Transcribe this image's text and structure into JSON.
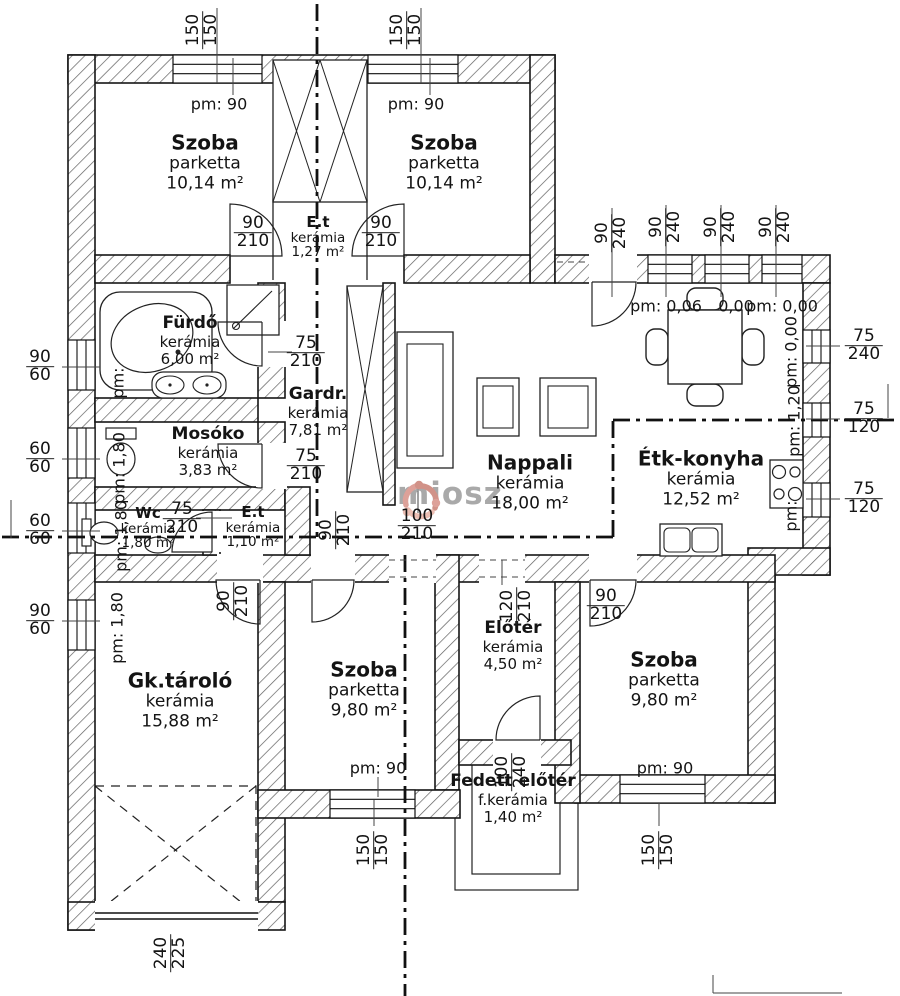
{
  "watermark": {
    "text": "miosz",
    "logo_colors": [
      "#c97f74",
      "#e8b3a6",
      "#d89188"
    ],
    "text_color": "#9b9b9b"
  },
  "rooms": {
    "szoba_tl": {
      "name": "Szoba",
      "floor": "parketta",
      "area": "10,14 m²"
    },
    "szoba_tm": {
      "name": "Szoba",
      "floor": "parketta",
      "area": "10,14 m²"
    },
    "et_top": {
      "name": "E.t",
      "floor": "kerámia",
      "area": "1,27 m²"
    },
    "furdo": {
      "name": "Fürdő",
      "floor": "kerámia",
      "area": "6,00 m²"
    },
    "gardr": {
      "name": "Gardr.",
      "floor": "kerámia",
      "area": "7,81 m²"
    },
    "mosoko": {
      "name": "Mosóko",
      "floor": "kerámia",
      "area": "3,83 m²"
    },
    "wc": {
      "name": "Wc",
      "floor": "kerámia",
      "area": "1,80 m²"
    },
    "et_small": {
      "name": "E.t",
      "floor": "kerámia",
      "area": "1,10 m²"
    },
    "nappali": {
      "name": "Nappali",
      "floor": "kerámia",
      "area": "18,00 m²"
    },
    "etk_konyha": {
      "name": "Étk-konyha",
      "floor": "kerámia",
      "area": "12,52 m²"
    },
    "gk_tarolo": {
      "name": "Gk.tároló",
      "floor": "kerámia",
      "area": "15,88 m²"
    },
    "szoba_bm": {
      "name": "Szoba",
      "floor": "parketta",
      "area": "9,80 m²"
    },
    "eloter": {
      "name": "Előtér",
      "floor": "kerámia",
      "area": "4,50 m²"
    },
    "szoba_br": {
      "name": "Szoba",
      "floor": "parketta",
      "area": "9,80 m²"
    },
    "fedett_eloter": {
      "name": "Fedett előtér",
      "floor": "f.kerámia",
      "area": "1,40 m²"
    }
  },
  "pm_labels": {
    "tl": "pm: 90",
    "tm": "pm: 90",
    "k1": "pm: 0,06",
    "k2": "0,00",
    "k3": "pm: 0,00",
    "kr1": "pm: 0,00",
    "kr2": "pm: 1,20",
    "kr3": "pm:",
    "furdo": "pm:",
    "mosoko": "pm: 1,80",
    "wc": "pm: 1,80",
    "gk": "pm: 1,80",
    "bm": "pm: 90",
    "br": "pm: 90"
  },
  "dims": {
    "tw1": {
      "a": "150",
      "b": "150"
    },
    "tw2": {
      "a": "150",
      "b": "150"
    },
    "trd": {
      "a": "90",
      "b": "240"
    },
    "trw1": {
      "a": "90",
      "b": "240"
    },
    "trw2": {
      "a": "90",
      "b": "240"
    },
    "trw3": {
      "a": "90",
      "b": "240"
    },
    "rw1": {
      "a": "75",
      "b": "240"
    },
    "rw2": {
      "a": "75",
      "b": "120"
    },
    "rw3": {
      "a": "75",
      "b": "120"
    },
    "lw1": {
      "a": "90",
      "b": "60"
    },
    "lw2": {
      "a": "60",
      "b": "60"
    },
    "lw3": {
      "a": "60",
      "b": "60"
    },
    "lw4": {
      "a": "90",
      "b": "60"
    },
    "dtl": {
      "a": "90",
      "b": "210"
    },
    "dtm": {
      "a": "90",
      "b": "210"
    },
    "dfu": {
      "a": "75",
      "b": "210"
    },
    "dga": {
      "a": "75",
      "b": "210"
    },
    "dwc": {
      "a": "75",
      "b": "210"
    },
    "dna": {
      "a": "100",
      "b": "210"
    },
    "oph": {
      "a": "90",
      "b": "210"
    },
    "dgk": {
      "a": "90",
      "b": "210"
    },
    "del": {
      "a": "120",
      "b": "210"
    },
    "dbr": {
      "a": "90",
      "b": "210"
    },
    "dmn": {
      "a": "100",
      "b": "240"
    },
    "dgr": {
      "a": "240",
      "b": "225"
    },
    "bwm": {
      "a": "150",
      "b": "150"
    },
    "bwr": {
      "a": "150",
      "b": "150"
    }
  }
}
